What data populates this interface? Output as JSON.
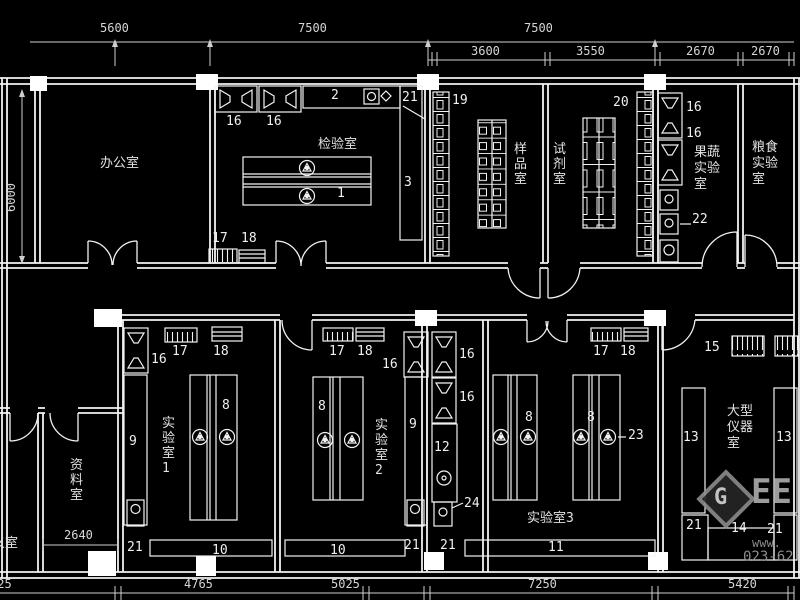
{
  "colors": {
    "background": "#000000",
    "line": "#f2f2f2",
    "dim_text": "#d6d6d6",
    "watermark": "#9a9a9a"
  },
  "dimensions": {
    "top": [
      {
        "t": "5600",
        "x": 100,
        "y": 21
      },
      {
        "t": "7500",
        "x": 298,
        "y": 21
      },
      {
        "t": "7500",
        "x": 524,
        "y": 21
      }
    ],
    "sub": [
      {
        "t": "3600",
        "x": 471,
        "y": 44
      },
      {
        "t": "3550",
        "x": 576,
        "y": 44
      },
      {
        "t": "2670",
        "x": 686,
        "y": 44
      },
      {
        "t": "2670",
        "x": 751,
        "y": 44
      }
    ],
    "left": [
      {
        "t": "6000",
        "x": 4,
        "y": 212
      }
    ],
    "interior": [
      {
        "t": "2640",
        "x": 64,
        "y": 528
      }
    ],
    "bottom": [
      {
        "t": "725",
        "x": -10,
        "y": 577
      },
      {
        "t": "4765",
        "x": 184,
        "y": 577
      },
      {
        "t": "5025",
        "x": 331,
        "y": 577
      },
      {
        "t": "7250",
        "x": 528,
        "y": 577
      },
      {
        "t": "5420",
        "x": 728,
        "y": 577
      }
    ]
  },
  "rooms": [
    {
      "name": "办公室",
      "x": 100,
      "y": 152,
      "mode": "h"
    },
    {
      "name": "检验室",
      "x": 318,
      "y": 133,
      "mode": "h"
    },
    {
      "name": "样品室",
      "x": 514,
      "y": 142,
      "mode": "v"
    },
    {
      "name": "试剂室",
      "x": 553,
      "y": 142,
      "mode": "v"
    },
    {
      "name": "果蔬实验室",
      "x": 694,
      "y": 145,
      "mode": "v2"
    },
    {
      "name": "粮食实验室",
      "x": 752,
      "y": 140,
      "mode": "v2"
    },
    {
      "name": "资料室",
      "x": 70,
      "y": 458,
      "mode": "v"
    },
    {
      "name": "义室",
      "x": -8,
      "y": 532,
      "mode": "h"
    },
    {
      "name": "实验室1",
      "x": 162,
      "y": 416,
      "mode": "v"
    },
    {
      "name": "实验室2",
      "x": 375,
      "y": 418,
      "mode": "v"
    },
    {
      "name": "实验室3",
      "x": 527,
      "y": 507,
      "mode": "h"
    },
    {
      "name": "大型仪器室",
      "x": 727,
      "y": 404,
      "mode": "v2"
    }
  ],
  "callouts": [
    {
      "t": "16",
      "x": 226,
      "y": 114
    },
    {
      "t": "16",
      "x": 266,
      "y": 114
    },
    {
      "t": "2",
      "x": 331,
      "y": 88
    },
    {
      "t": "21",
      "x": 402,
      "y": 90
    },
    {
      "t": "19",
      "x": 452,
      "y": 93
    },
    {
      "t": "3",
      "x": 404,
      "y": 175
    },
    {
      "t": "1",
      "x": 337,
      "y": 186
    },
    {
      "t": "17",
      "x": 212,
      "y": 231
    },
    {
      "t": "18",
      "x": 241,
      "y": 231
    },
    {
      "t": "20",
      "x": 613,
      "y": 95
    },
    {
      "t": "16",
      "x": 686,
      "y": 100
    },
    {
      "t": "16",
      "x": 686,
      "y": 126
    },
    {
      "t": "22",
      "x": 692,
      "y": 212
    },
    {
      "t": "16",
      "x": 151,
      "y": 352
    },
    {
      "t": "17",
      "x": 172,
      "y": 344
    },
    {
      "t": "18",
      "x": 213,
      "y": 344
    },
    {
      "t": "8",
      "x": 222,
      "y": 398
    },
    {
      "t": "9",
      "x": 129,
      "y": 434
    },
    {
      "t": "21",
      "x": 127,
      "y": 540
    },
    {
      "t": "10",
      "x": 212,
      "y": 543
    },
    {
      "t": "17",
      "x": 329,
      "y": 344
    },
    {
      "t": "18",
      "x": 357,
      "y": 344
    },
    {
      "t": "16",
      "x": 382,
      "y": 357
    },
    {
      "t": "8",
      "x": 318,
      "y": 399
    },
    {
      "t": "9",
      "x": 409,
      "y": 417
    },
    {
      "t": "16",
      "x": 459,
      "y": 347
    },
    {
      "t": "16",
      "x": 459,
      "y": 390
    },
    {
      "t": "12",
      "x": 434,
      "y": 440
    },
    {
      "t": "24",
      "x": 464,
      "y": 496
    },
    {
      "t": "21",
      "x": 404,
      "y": 538
    },
    {
      "t": "21",
      "x": 440,
      "y": 538
    },
    {
      "t": "10",
      "x": 330,
      "y": 543
    },
    {
      "t": "8",
      "x": 525,
      "y": 410
    },
    {
      "t": "8",
      "x": 587,
      "y": 410
    },
    {
      "t": "23",
      "x": 628,
      "y": 428
    },
    {
      "t": "17",
      "x": 593,
      "y": 344
    },
    {
      "t": "18",
      "x": 620,
      "y": 344
    },
    {
      "t": "11",
      "x": 548,
      "y": 540
    },
    {
      "t": "15",
      "x": 704,
      "y": 340
    },
    {
      "t": "13",
      "x": 683,
      "y": 430
    },
    {
      "t": "13",
      "x": 776,
      "y": 430
    },
    {
      "t": "21",
      "x": 686,
      "y": 518
    },
    {
      "t": "14",
      "x": 731,
      "y": 521
    },
    {
      "t": "21",
      "x": 767,
      "y": 522
    }
  ],
  "watermark": {
    "logo_letter": "G",
    "brand": "EE",
    "url": "www.",
    "phone": "023-62"
  }
}
